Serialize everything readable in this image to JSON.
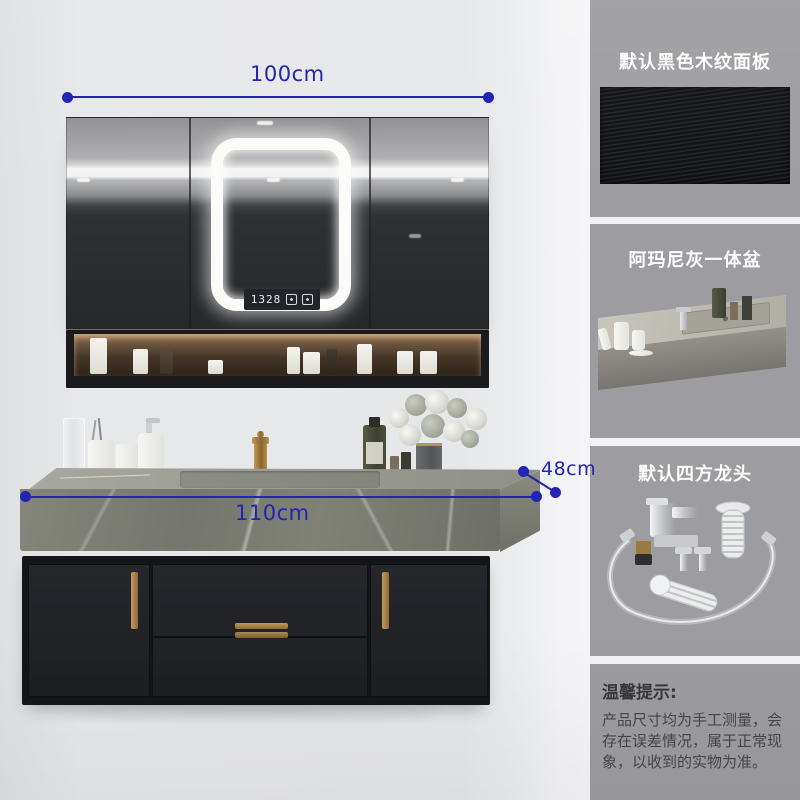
{
  "colors": {
    "annotation_blue": "#2424b4",
    "sidebar_gray": "#9d9da1",
    "cabinet_black": "#202125",
    "handle_gold": "#b08a4e",
    "marble_gray": "#7e7f75"
  },
  "annotations": {
    "mirror_width": "100cm",
    "counter_width": "110cm",
    "counter_depth": "48cm"
  },
  "mirror": {
    "clock": "1328",
    "icons": [
      "defog-icon",
      "light-control-icon"
    ]
  },
  "sidebar": {
    "sections": [
      {
        "label": "默认黑色木纹面板"
      },
      {
        "label": "阿玛尼灰一体盆"
      },
      {
        "label": "默认四方龙头"
      }
    ],
    "notice": {
      "heading": "温馨提示:",
      "body": "产品尺寸均为手工测量，会存在误差情况，属于正常现象，以收到的实物为准。"
    }
  }
}
